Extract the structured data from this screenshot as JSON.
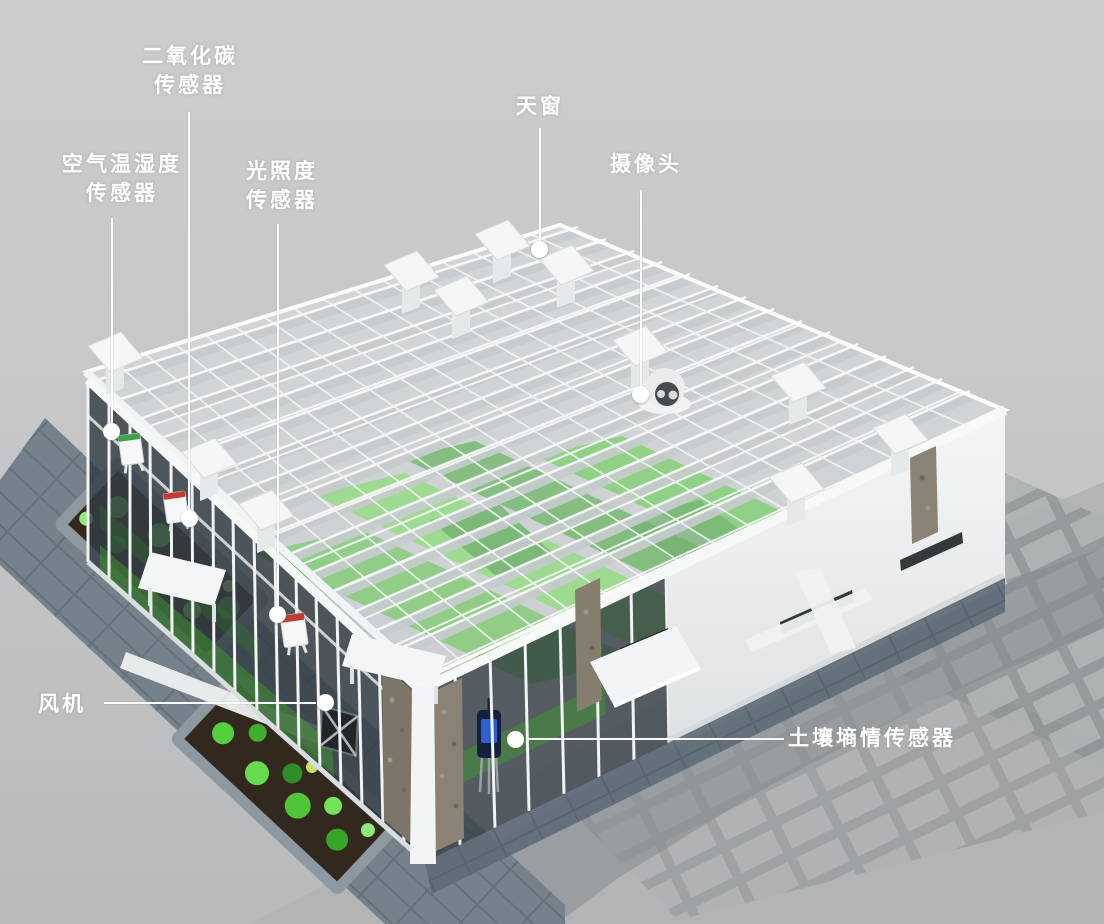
{
  "labels": {
    "co2_sensor": {
      "line1": "二氧化碳",
      "line2": "传感器"
    },
    "air_temp_humidity_sensor": {
      "line1": "空气温湿度",
      "line2": "传感器"
    },
    "light_intensity_sensor": {
      "line1": "光照度",
      "line2": "传感器"
    },
    "skylight": {
      "text": "天窗"
    },
    "camera": {
      "text": "摄像头"
    },
    "fan": {
      "text": "风机"
    },
    "soil_moisture_sensor": {
      "text": "土壤墒情传感器"
    }
  },
  "colors": {
    "background": "#c8c9cb",
    "label_text": "#ffffff",
    "leader_line": "#fafbfb",
    "glass_frame_white": "#f7f9f9",
    "crop_green": "#55c23c",
    "crop_green_dark": "#2f8f27",
    "walkway_stone_blue": "#75828b",
    "planter_soil_brown": "#33281e",
    "pavement_gray": "#b3b5b6",
    "building_shadow_gray": "#8d9193",
    "soil_sensor_blue": "#2e5fd0",
    "sensor_stripe_red": "#c43b33",
    "sensor_stripe_green": "#3fa34d",
    "camera_face_dark": "#454a4e"
  }
}
